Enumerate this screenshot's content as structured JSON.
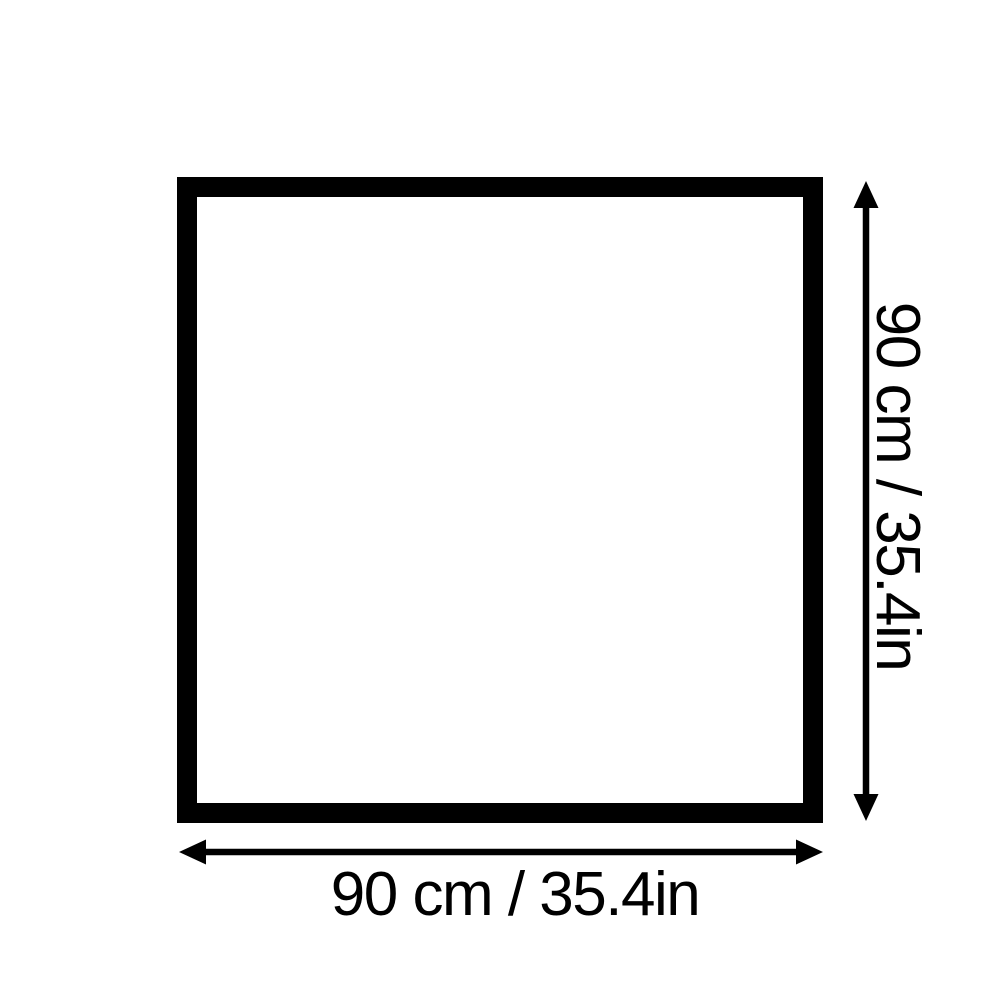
{
  "diagram": {
    "type": "product-dimension-diagram",
    "background": "#ffffff",
    "line_color": "#000000",
    "shape": "square",
    "width_dimension": "90 cm / 35.4in",
    "height_dimension": "90 cm / 35.4in",
    "width_value_cm": 90,
    "width_value_in": 35.4,
    "height_value_cm": 90,
    "height_value_in": 35.4
  }
}
